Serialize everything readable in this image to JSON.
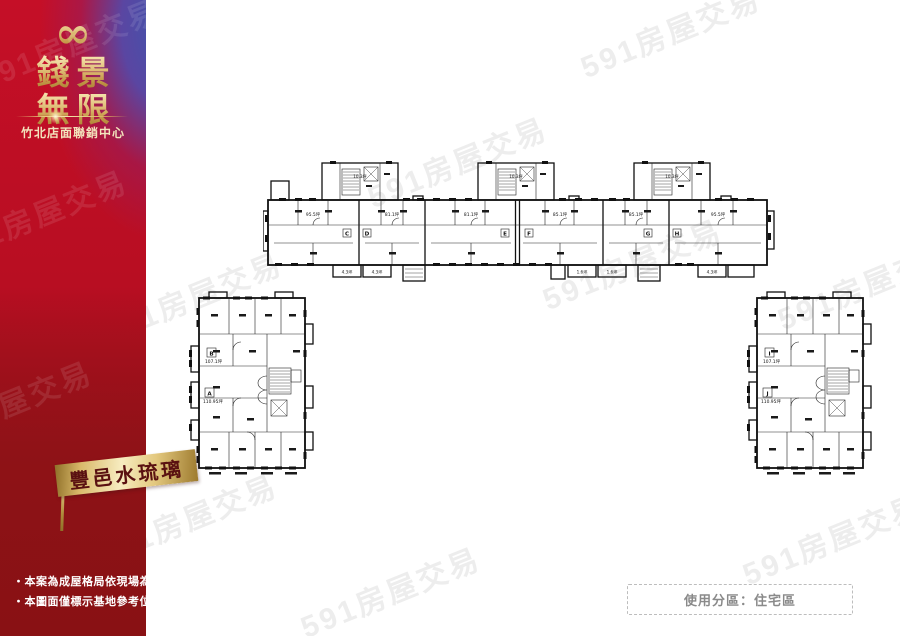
{
  "watermark": {
    "text": "591房屋交易"
  },
  "sidebar": {
    "infinity_symbol": "∞",
    "title_line1": "錢景",
    "title_line2": "無限",
    "subtitle": "竹北店面聯銷中心",
    "disclaimer_line1": "‧本案為成屋格局依現場為準",
    "disclaimer_line2": "‧本圖面僅標示基地參考位置",
    "colors": {
      "red_top": "#c50f27",
      "red_bottom": "#8c1216",
      "blue_accent": "#3e55ad",
      "gold": "#d9b465"
    }
  },
  "banner": {
    "label": "豐邑水琉璃",
    "text_color": "#5a1111"
  },
  "zoning_box": {
    "label": "使用分區：住宅區"
  },
  "floorplan": {
    "top_building": {
      "core_labels": [
        "10.3坪",
        "10.3坪",
        "10.3坪"
      ],
      "units": [
        {
          "letter": "C",
          "area": "95.5坪"
        },
        {
          "letter": "D",
          "area": "81.1坪"
        },
        {
          "letter": "E",
          "area": "81.1坪"
        },
        {
          "letter": "F",
          "area": "85.1坪"
        },
        {
          "letter": "G",
          "area": "85.1坪"
        },
        {
          "letter": "H",
          "area": "95.5坪"
        }
      ],
      "balconies": [
        "4.3坪",
        "4.3坪",
        "1.6坪",
        "1.6坪",
        "4.3坪"
      ]
    },
    "left_block": {
      "units": [
        {
          "letter": "B",
          "area": "107.1坪"
        },
        {
          "letter": "A",
          "area": "110.95坪"
        }
      ]
    },
    "right_block": {
      "units": [
        {
          "letter": "I",
          "area": "107.1坪"
        },
        {
          "letter": "J",
          "area": "110.95坪"
        }
      ]
    }
  }
}
